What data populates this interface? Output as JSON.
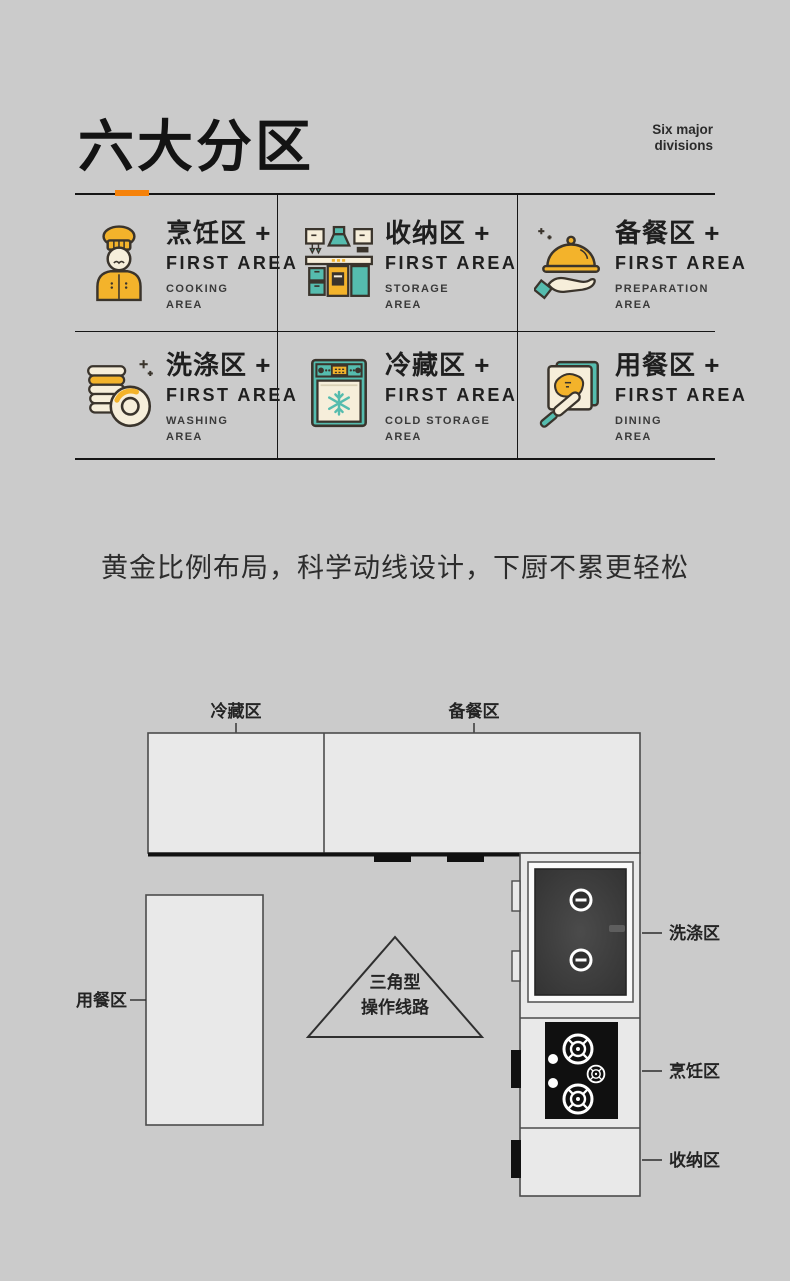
{
  "header": {
    "title": "六大分区",
    "subtitle_line1": "Six major",
    "subtitle_line2": "divisions"
  },
  "tagline": "黄金比例布局，科学动线设计，下厨不累更轻松",
  "cards": [
    {
      "title": "烹饪区 +",
      "subtitle": "FIRST AREA",
      "area_line1": "COOKING",
      "area_line2": "AREA",
      "icon": "chef-icon"
    },
    {
      "title": "收纳区 +",
      "subtitle": "FIRST AREA",
      "area_line1": "STORAGE",
      "area_line2": "AREA",
      "icon": "kitchen-cabinet-icon"
    },
    {
      "title": "备餐区 +",
      "subtitle": "FIRST AREA",
      "area_line1": "PREPARATION",
      "area_line2": "AREA",
      "icon": "serving-cloche-icon"
    },
    {
      "title": "洗涤区 +",
      "subtitle": "FIRST AREA",
      "area_line1": "WASHING",
      "area_line2": "AREA",
      "icon": "dishes-icon"
    },
    {
      "title": "冷藏区 +",
      "subtitle": "FIRST AREA",
      "area_line1": "COLD STORAGE",
      "area_line2": "AREA",
      "icon": "freezer-icon"
    },
    {
      "title": "用餐区 +",
      "subtitle": "FIRST AREA",
      "area_line1": "DINING",
      "area_line2": "AREA",
      "icon": "toast-icon"
    }
  ],
  "floor_plan": {
    "labels": {
      "cold_storage": "冷藏区",
      "preparation": "备餐区",
      "dining": "用餐区",
      "washing": "洗涤区",
      "cooking": "烹饪区",
      "storage": "收纳区"
    },
    "triangle_line1": "三角型",
    "triangle_line2": "操作线路"
  },
  "colors": {
    "background": "#cbcbcb",
    "accent_orange": "#f5820b",
    "icon_yellow": "#f3b32b",
    "icon_teal": "#55bcae",
    "icon_cream": "#f6eeda",
    "icon_outline": "#3a342c",
    "plan_fill": "#e9e9e9",
    "plan_stroke": "#4c4c4c",
    "sink_dark": "#3c3c3c",
    "cooktop_black": "#101010",
    "line_dark": "#161616"
  }
}
